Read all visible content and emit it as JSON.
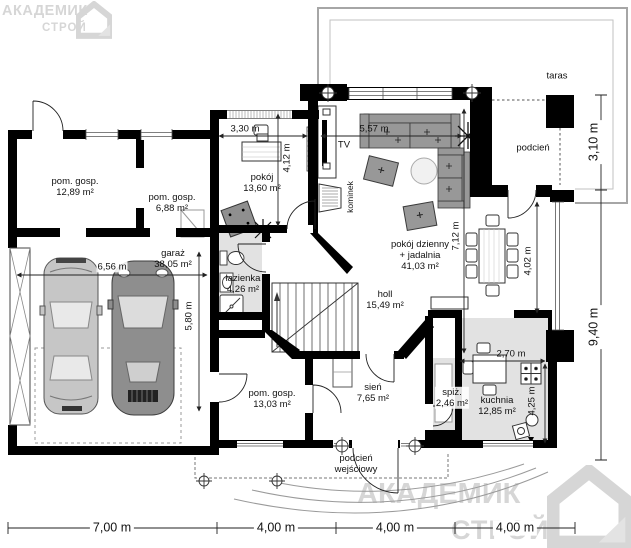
{
  "brand": {
    "line1": "АКАДЕМИК",
    "line2": "СТРОЙ"
  },
  "rooms": {
    "pom_gosp_1": {
      "name": "pom. gosp.",
      "area": "12,89 m²"
    },
    "pom_gosp_2": {
      "name": "pom. gosp.",
      "area": "6,88 m²"
    },
    "pokoj": {
      "name": "pokój",
      "area": "13,60 m²"
    },
    "garaz": {
      "name": "garaż",
      "area": "38,05 m²"
    },
    "lazienka": {
      "name": "łazienka",
      "area": "4,26 m²"
    },
    "salon": {
      "line1": "pokój dzienny",
      "line2": "+ jadalnia",
      "area": "41,03 m²"
    },
    "holl": {
      "name": "holl",
      "area": "15,49 m²"
    },
    "pom_gosp_3": {
      "name": "pom. gosp.",
      "area": "13,03 m²"
    },
    "sien": {
      "name": "sień",
      "area": "7,65 m²"
    },
    "spiz": {
      "name": "spiż.",
      "area": "2,46 m²"
    },
    "kuchnia": {
      "name": "kuchnia",
      "area": "12,85 m²"
    }
  },
  "labels": {
    "taras": "taras",
    "podcien": "podcień",
    "porch_line1": "podcień",
    "porch_line2": "wejściowy",
    "tv": "TV",
    "kominek": "kominek"
  },
  "dims": {
    "bottom": [
      "7,00 m",
      "4,00 m",
      "4,00 m",
      "4,00 m"
    ],
    "right_top": "3,10 m",
    "right_bottom": "9,40 m",
    "pokoj_w": "3,30 m",
    "pokoj_h": "4,12 m",
    "salon_w": "5,57 m",
    "salon_h": "7,12 m",
    "jadalnia_h": "4,02 m",
    "garaz_w": "6,56 m",
    "garaz_h": "5,80 m",
    "kuchnia_w": "2,70 m",
    "kuchnia_h": "4,25 m"
  },
  "colors": {
    "wall": "#000000",
    "wet_room_fill": "#e2e2e2",
    "watermark": "#d6d6d6"
  }
}
